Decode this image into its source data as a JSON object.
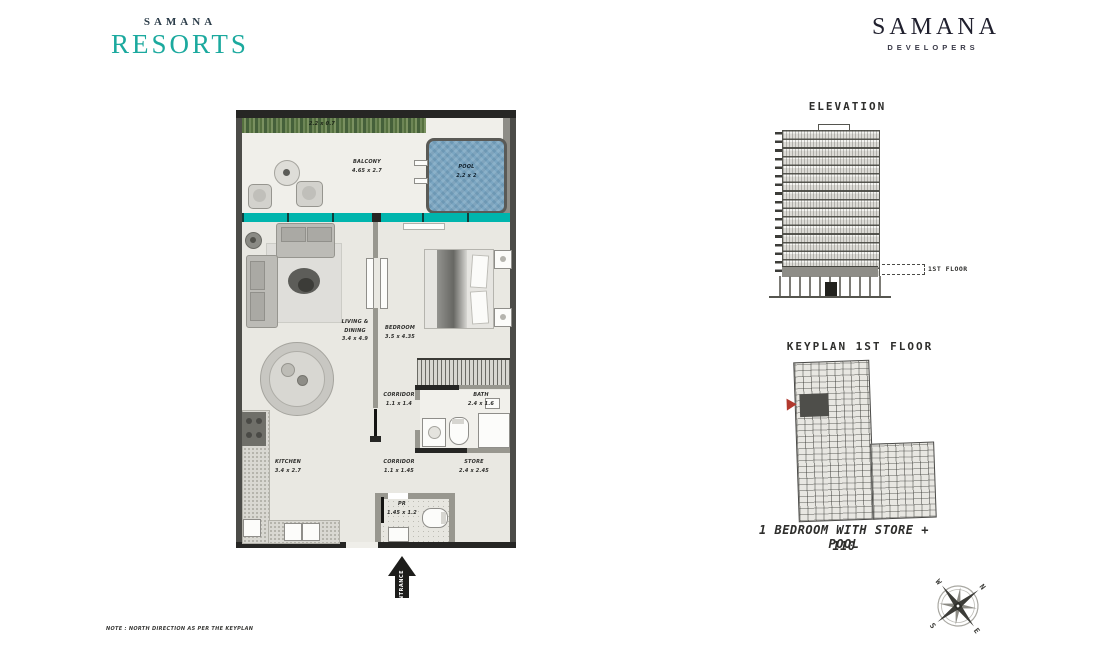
{
  "logo_resorts": {
    "top": "SAMANA",
    "main": "RESORTS"
  },
  "logo_developers": {
    "main": "SAMANA",
    "sub": "DEVELOPERS"
  },
  "plan": {
    "planter_dims": "2.2 x 0.7",
    "balcony": {
      "label": "BALCONY",
      "dims": "4.65 x 2.7"
    },
    "pool": {
      "label": "POOL",
      "dims": "2.2 x 2"
    },
    "living": {
      "line1": "LIVING &",
      "line2": "DINING",
      "dims": "3.4 x 4.9"
    },
    "bedroom": {
      "label": "BEDROOM",
      "dims": "3.5 x 4.35"
    },
    "corridor1": {
      "label": "CORRIDOR",
      "dims": "1.1 x 1.4"
    },
    "bath": {
      "label": "BATH",
      "dims": "2.4 x 1.6"
    },
    "kitchen": {
      "label": "KITCHEN",
      "dims": "3.4 x 2.7"
    },
    "corridor2": {
      "label": "CORRIDOR",
      "dims": "1.1 x 1.45"
    },
    "store": {
      "label": "STORE",
      "dims": "2.4 x 2.45"
    },
    "pr": {
      "label": "PR",
      "dims": "1.45 x 1.2"
    },
    "entrance": "ENTRANCE"
  },
  "elevation": {
    "title": "ELEVATION",
    "floor_label": "1ST FLOOR"
  },
  "keyplan": {
    "title": "KEYPLAN 1ST FLOOR"
  },
  "unit": {
    "name": "1 BEDROOM WITH STORE + POOL",
    "number": "110"
  },
  "compass": {
    "n": "N",
    "e": "E",
    "s": "S",
    "w": "W"
  },
  "note": "NOTE : NORTH DIRECTION AS PER THE KEYPLAN",
  "colors": {
    "teal_band": "#00b5ad",
    "logo_teal": "#1ba99e",
    "pool_blue": "#7ba6c2",
    "hedge_green": "#6d8656",
    "marker_red": "#b2392e",
    "wall_dark": "#262624"
  }
}
